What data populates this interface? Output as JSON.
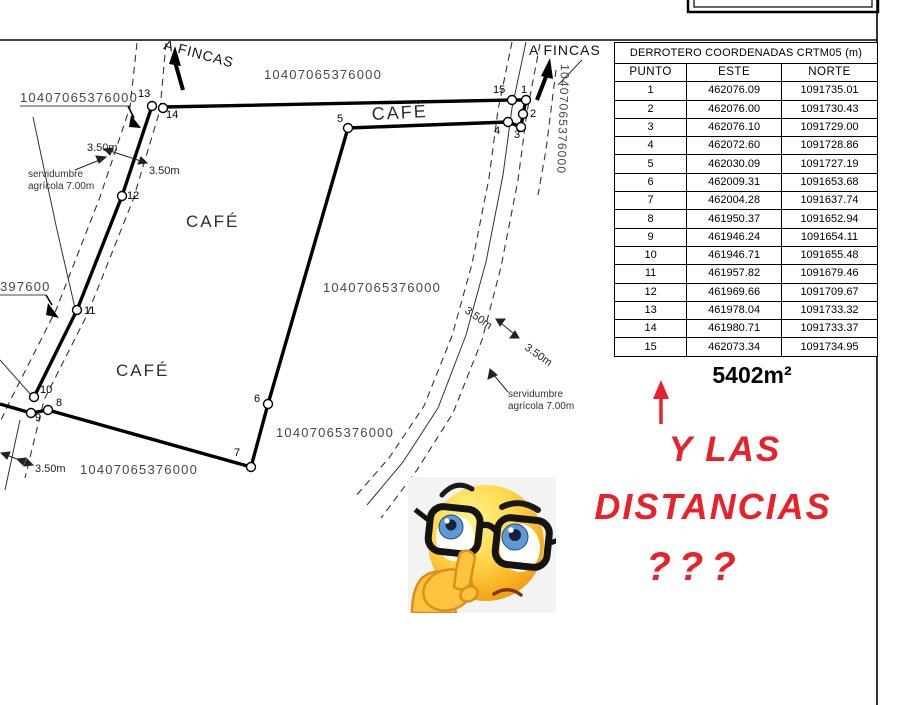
{
  "table": {
    "title": "DERROTERO COORDENADAS CRTM05 (m)",
    "columns": [
      "PUNTO",
      "ESTE",
      "NORTE"
    ],
    "rows": [
      [
        "1",
        "462076.09",
        "1091735.01"
      ],
      [
        "2",
        "462076.00",
        "1091730.43"
      ],
      [
        "3",
        "462076.10",
        "1091729.00"
      ],
      [
        "4",
        "462072.60",
        "1091728.86"
      ],
      [
        "5",
        "462030.09",
        "1091727.19"
      ],
      [
        "6",
        "462009.31",
        "1091653.68"
      ],
      [
        "7",
        "462004.28",
        "1091637.74"
      ],
      [
        "8",
        "461950.37",
        "1091652.94"
      ],
      [
        "9",
        "461946.24",
        "1091654.11"
      ],
      [
        "10",
        "461946.71",
        "1091655.48"
      ],
      [
        "11",
        "461957.82",
        "1091679.46"
      ],
      [
        "12",
        "461969.66",
        "1091709.67"
      ],
      [
        "13",
        "461978.04",
        "1091733.32"
      ],
      [
        "14",
        "461980.71",
        "1091733.37"
      ],
      [
        "15",
        "462073.34",
        "1091734.95"
      ]
    ],
    "area": "5402m²"
  },
  "map": {
    "apn": "10407065376000",
    "apn_partial": "397600",
    "road_destination": "A FINCAS",
    "crop": "CAFÉ",
    "easement_line1": "servidumbre",
    "easement_line2": "agrícola 7.00m",
    "half_width": "3.50m",
    "point_labels": [
      "1",
      "2",
      "3",
      "4",
      "5",
      "6",
      "7",
      "8",
      "9",
      "10",
      "11",
      "12",
      "13",
      "14",
      "15"
    ]
  },
  "annotation": {
    "line1": "Y LAS",
    "line2": "DISTANCIAS",
    "line3": "???",
    "color": "#e8222a"
  },
  "emoji": {
    "name": "thinking-face-with-glasses"
  },
  "colors": {
    "line": "#000000",
    "map_text": "#474747"
  }
}
